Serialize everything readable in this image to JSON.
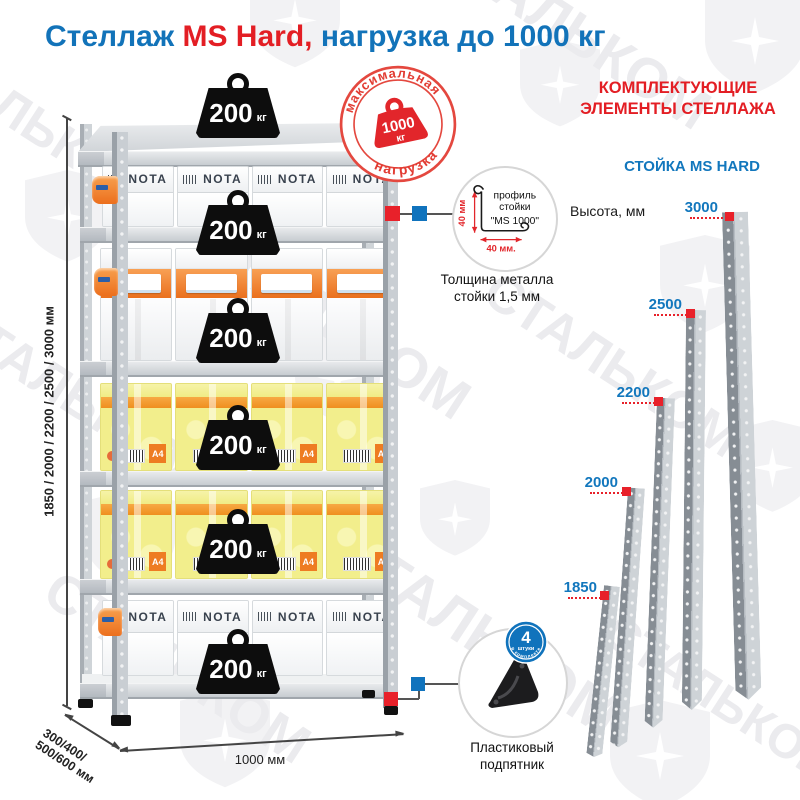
{
  "title": {
    "part1": "Стеллаж ",
    "part2": "MS Hard,",
    "part3": " нагрузка до 1000 кг"
  },
  "watermark": {
    "text": "СТАЛЬКОМ"
  },
  "max_load_badge": {
    "arc_top": "максимальная",
    "arc_bottom": "нагрузка",
    "value": "1000",
    "unit": "кг"
  },
  "shelf": {
    "weight_value": "200",
    "weight_unit": "кг",
    "box_brand": "NOTA",
    "a4_label": "A4"
  },
  "dimensions": {
    "height_options": "1850 / 2000 / 2200 / 2500 / 3000 мм",
    "depth_line1": "300/400/",
    "depth_line2": "500/600 мм",
    "width": "1000 мм"
  },
  "profile_detail": {
    "line1": "профиль",
    "line2": "стойки",
    "line3": "\"MS 1000\"",
    "dim_vertical": "40 мм",
    "dim_horizontal": "40 мм.",
    "caption_line1": "Толщина металла",
    "caption_line2": "стойки 1,5 мм"
  },
  "foot_detail": {
    "badge_value": "4",
    "badge_word": "штуки",
    "badge_arc": "в комплекте",
    "caption_line1": "Пластиковый",
    "caption_line2": "подпятник"
  },
  "components": {
    "heading_line1": "КОМПЛЕКТУЮЩИЕ",
    "heading_line2": "ЭЛЕМЕНТЫ СТЕЛЛАЖА",
    "subheading": "СТОЙКА MS HARD",
    "axis_label": "Высота, мм",
    "posts": [
      {
        "height": "3000"
      },
      {
        "height": "2500"
      },
      {
        "height": "2200"
      },
      {
        "height": "2000"
      },
      {
        "height": "1850"
      }
    ]
  }
}
